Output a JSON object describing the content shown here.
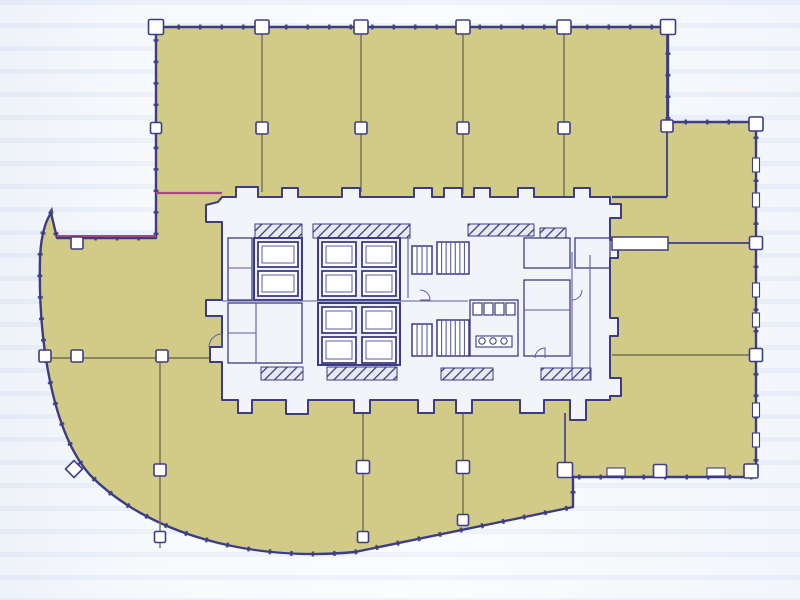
{
  "title": "office-tower-floor-plan",
  "palette": {
    "background": "#f5f7fb",
    "floor_fill": "#d2cb88",
    "wall_navy": "#3c3c84",
    "wall_mid": "#5b5ba6",
    "line_olive": "#6f6f54",
    "accent_magenta": "#a4487e",
    "core_fill": "#f3f4f9",
    "white": "#ffffff"
  },
  "canvas": {
    "width": 800,
    "height": 600
  },
  "outline": {
    "path": "M 156 27 L 668 27 L 668 122 L 756 122 L 756 477 L 573 477 L 573 507 L 355 552 C 250 562 148 534 90 475 C 52 432 38 340 40 258 C 41 235 45 222 51 213 L 57 238 L 156 238 Z",
    "stroke_width": 2.4,
    "tick_dash": "2.5 19",
    "tick_width": 5
  },
  "core": {
    "path": "M 222 197 L 236 197 L 236 187 L 258 187 L 258 197 L 282 197 L 282 188 L 298 188 L 298 197 L 342 197 L 342 188 L 360 188 L 360 197 L 414 197 L 414 188 L 432 188 L 432 197 L 444 197 L 444 188 L 462 188 L 462 197 L 474 197 L 474 188 L 490 188 L 490 197 L 518 197 L 518 188 L 534 188 L 534 197 L 574 197 L 574 188 L 590 188 L 590 197 L 610 197 L 610 204 L 621 204 L 621 218 L 610 218 L 610 240 L 618 240 L 618 258 L 610 258 L 610 318 L 618 318 L 618 336 L 610 336 L 610 378 L 621 378 L 621 396 L 610 396 L 610 400 L 586 400 L 586 420 L 570 420 L 570 400 L 544 400 L 544 413 L 520 413 L 520 400 L 472 400 L 472 413 L 456 413 L 456 400 L 434 400 L 434 413 L 418 413 L 418 400 L 370 400 L 370 413 L 354 413 L 354 400 L 308 400 L 308 414 L 286 414 L 286 400 L 252 400 L 252 413 L 238 413 L 238 400 L 222 400 L 222 362 L 210 362 L 210 347 L 222 347 L 222 316 L 206 316 L 206 300 L 222 300 L 222 222 L 206 222 L 206 205 L 218 202 Z",
    "stroke_width": 2
  },
  "partitions": [
    [
      262,
      30,
      262,
      192,
      1.4,
      "line_olive"
    ],
    [
      361,
      30,
      361,
      192,
      1.4,
      "line_olive"
    ],
    [
      463,
      30,
      463,
      194,
      1.4,
      "line_olive"
    ],
    [
      564,
      30,
      564,
      196,
      1.4,
      "line_olive"
    ],
    [
      667,
      30,
      667,
      197,
      1.8,
      "wall_navy"
    ],
    [
      612,
      197,
      667,
      197,
      2.2,
      "wall_navy"
    ],
    [
      612,
      243,
      756,
      243,
      1.8,
      "wall_navy"
    ],
    [
      612,
      355,
      756,
      355,
      1.5,
      "line_olive"
    ],
    [
      42,
      358,
      212,
      358,
      1.5,
      "line_olive"
    ],
    [
      160,
      358,
      160,
      548,
      1.4,
      "line_olive"
    ],
    [
      363,
      413,
      363,
      538,
      1.4,
      "line_olive"
    ],
    [
      463,
      413,
      463,
      522,
      1.4,
      "line_olive"
    ],
    [
      565,
      413,
      565,
      470,
      1.6,
      "wall_navy"
    ]
  ],
  "accents": [
    [
      156,
      193,
      222,
      193,
      2.2,
      "accent_magenta"
    ],
    [
      57,
      236,
      156,
      236,
      2.0,
      "accent_magenta"
    ]
  ],
  "columns": {
    "squares": [
      [
        156,
        27,
        15
      ],
      [
        262,
        27,
        14
      ],
      [
        361,
        27,
        14
      ],
      [
        463,
        27,
        14
      ],
      [
        564,
        27,
        14
      ],
      [
        668,
        27,
        15
      ],
      [
        156,
        128,
        11
      ],
      [
        262,
        128,
        12
      ],
      [
        361,
        128,
        12
      ],
      [
        463,
        128,
        12
      ],
      [
        564,
        128,
        12
      ],
      [
        667,
        126,
        12
      ],
      [
        756,
        124,
        14
      ],
      [
        756,
        243,
        13
      ],
      [
        756,
        355,
        13
      ],
      [
        77,
        243,
        12
      ],
      [
        45,
        356,
        12
      ],
      [
        77,
        356,
        12
      ],
      [
        162,
        356,
        12
      ],
      [
        160,
        470,
        12
      ],
      [
        160,
        537,
        11
      ],
      [
        363,
        467,
        13
      ],
      [
        463,
        467,
        13
      ],
      [
        565,
        470,
        15
      ],
      [
        363,
        537,
        11
      ],
      [
        463,
        520,
        11
      ],
      [
        660,
        471,
        13
      ],
      [
        751,
        471,
        14
      ]
    ],
    "diamonds": [
      [
        74,
        469,
        12
      ]
    ],
    "slots_v": [
      [
        756,
        165
      ],
      [
        756,
        200
      ],
      [
        756,
        290
      ],
      [
        756,
        320
      ],
      [
        756,
        410
      ],
      [
        756,
        440
      ]
    ],
    "slots_h": [
      [
        616,
        472
      ],
      [
        716,
        472
      ]
    ]
  },
  "core_interior": {
    "hatch_rects": [
      [
        255,
        224,
        47,
        14
      ],
      [
        313,
        224,
        97,
        14
      ],
      [
        468,
        224,
        66,
        12
      ],
      [
        540,
        228,
        26,
        10
      ],
      [
        261,
        367,
        42,
        13
      ],
      [
        327,
        367,
        70,
        13
      ],
      [
        441,
        368,
        52,
        12
      ],
      [
        541,
        368,
        50,
        12
      ]
    ],
    "elevator_banks": [
      {
        "outer": [
          254,
          238,
          48,
          62
        ],
        "shafts": [
          [
            258,
            242,
            40,
            25
          ],
          [
            258,
            271,
            40,
            25
          ]
        ]
      },
      {
        "outer": [
          318,
          238,
          82,
          62
        ],
        "shafts": [
          [
            322,
            242,
            34,
            25
          ],
          [
            362,
            242,
            34,
            25
          ],
          [
            322,
            271,
            34,
            25
          ],
          [
            362,
            271,
            34,
            25
          ]
        ]
      },
      {
        "outer": [
          318,
          303,
          82,
          62
        ],
        "shafts": [
          [
            322,
            307,
            34,
            26
          ],
          [
            362,
            307,
            34,
            26
          ],
          [
            322,
            337,
            34,
            26
          ],
          [
            362,
            337,
            34,
            26
          ]
        ]
      }
    ],
    "stairs": [
      {
        "rect": [
          437,
          242,
          32,
          32
        ],
        "treads": 7
      },
      {
        "rect": [
          412,
          246,
          20,
          28
        ],
        "treads": 4
      },
      {
        "rect": [
          437,
          320,
          32,
          36
        ],
        "treads": 7
      },
      {
        "rect": [
          412,
          324,
          20,
          32
        ],
        "treads": 4
      }
    ],
    "rooms": [
      [
        228,
        238,
        24,
        62
      ],
      [
        228,
        303,
        74,
        60
      ],
      [
        470,
        300,
        48,
        56
      ],
      [
        524,
        238,
        46,
        30
      ],
      [
        575,
        238,
        35,
        30
      ],
      [
        524,
        280,
        46,
        76
      ]
    ],
    "lines": [
      [
        228,
        268,
        252,
        268
      ],
      [
        256,
        303,
        256,
        363
      ],
      [
        228,
        333,
        256,
        333
      ],
      [
        408,
        238,
        408,
        298
      ],
      [
        222,
        301,
        468,
        301
      ],
      [
        572,
        252,
        572,
        380
      ],
      [
        590,
        255,
        590,
        380
      ],
      [
        524,
        310,
        570,
        310
      ]
    ],
    "stalls": [
      [
        473,
        303
      ],
      [
        484,
        303
      ],
      [
        495,
        303
      ],
      [
        506,
        303
      ]
    ],
    "stall_size": [
      9,
      12
    ],
    "counter": [
      476,
      336,
      36,
      11
    ],
    "sinks": [
      [
        482,
        341
      ],
      [
        493,
        341
      ],
      [
        504,
        341
      ]
    ],
    "door_bars": [
      [
        612,
        237,
        56,
        13
      ]
    ],
    "door_arcs": [
      {
        "cx": 222,
        "cy": 347,
        "r": 13,
        "a0": 180,
        "a1": 270
      },
      {
        "cx": 572,
        "cy": 290,
        "r": 10,
        "a0": 0,
        "a1": 90
      },
      {
        "cx": 545,
        "cy": 358,
        "r": 10,
        "a0": 180,
        "a1": 270
      },
      {
        "cx": 420,
        "cy": 300,
        "r": 10,
        "a0": 270,
        "a1": 360
      }
    ]
  }
}
